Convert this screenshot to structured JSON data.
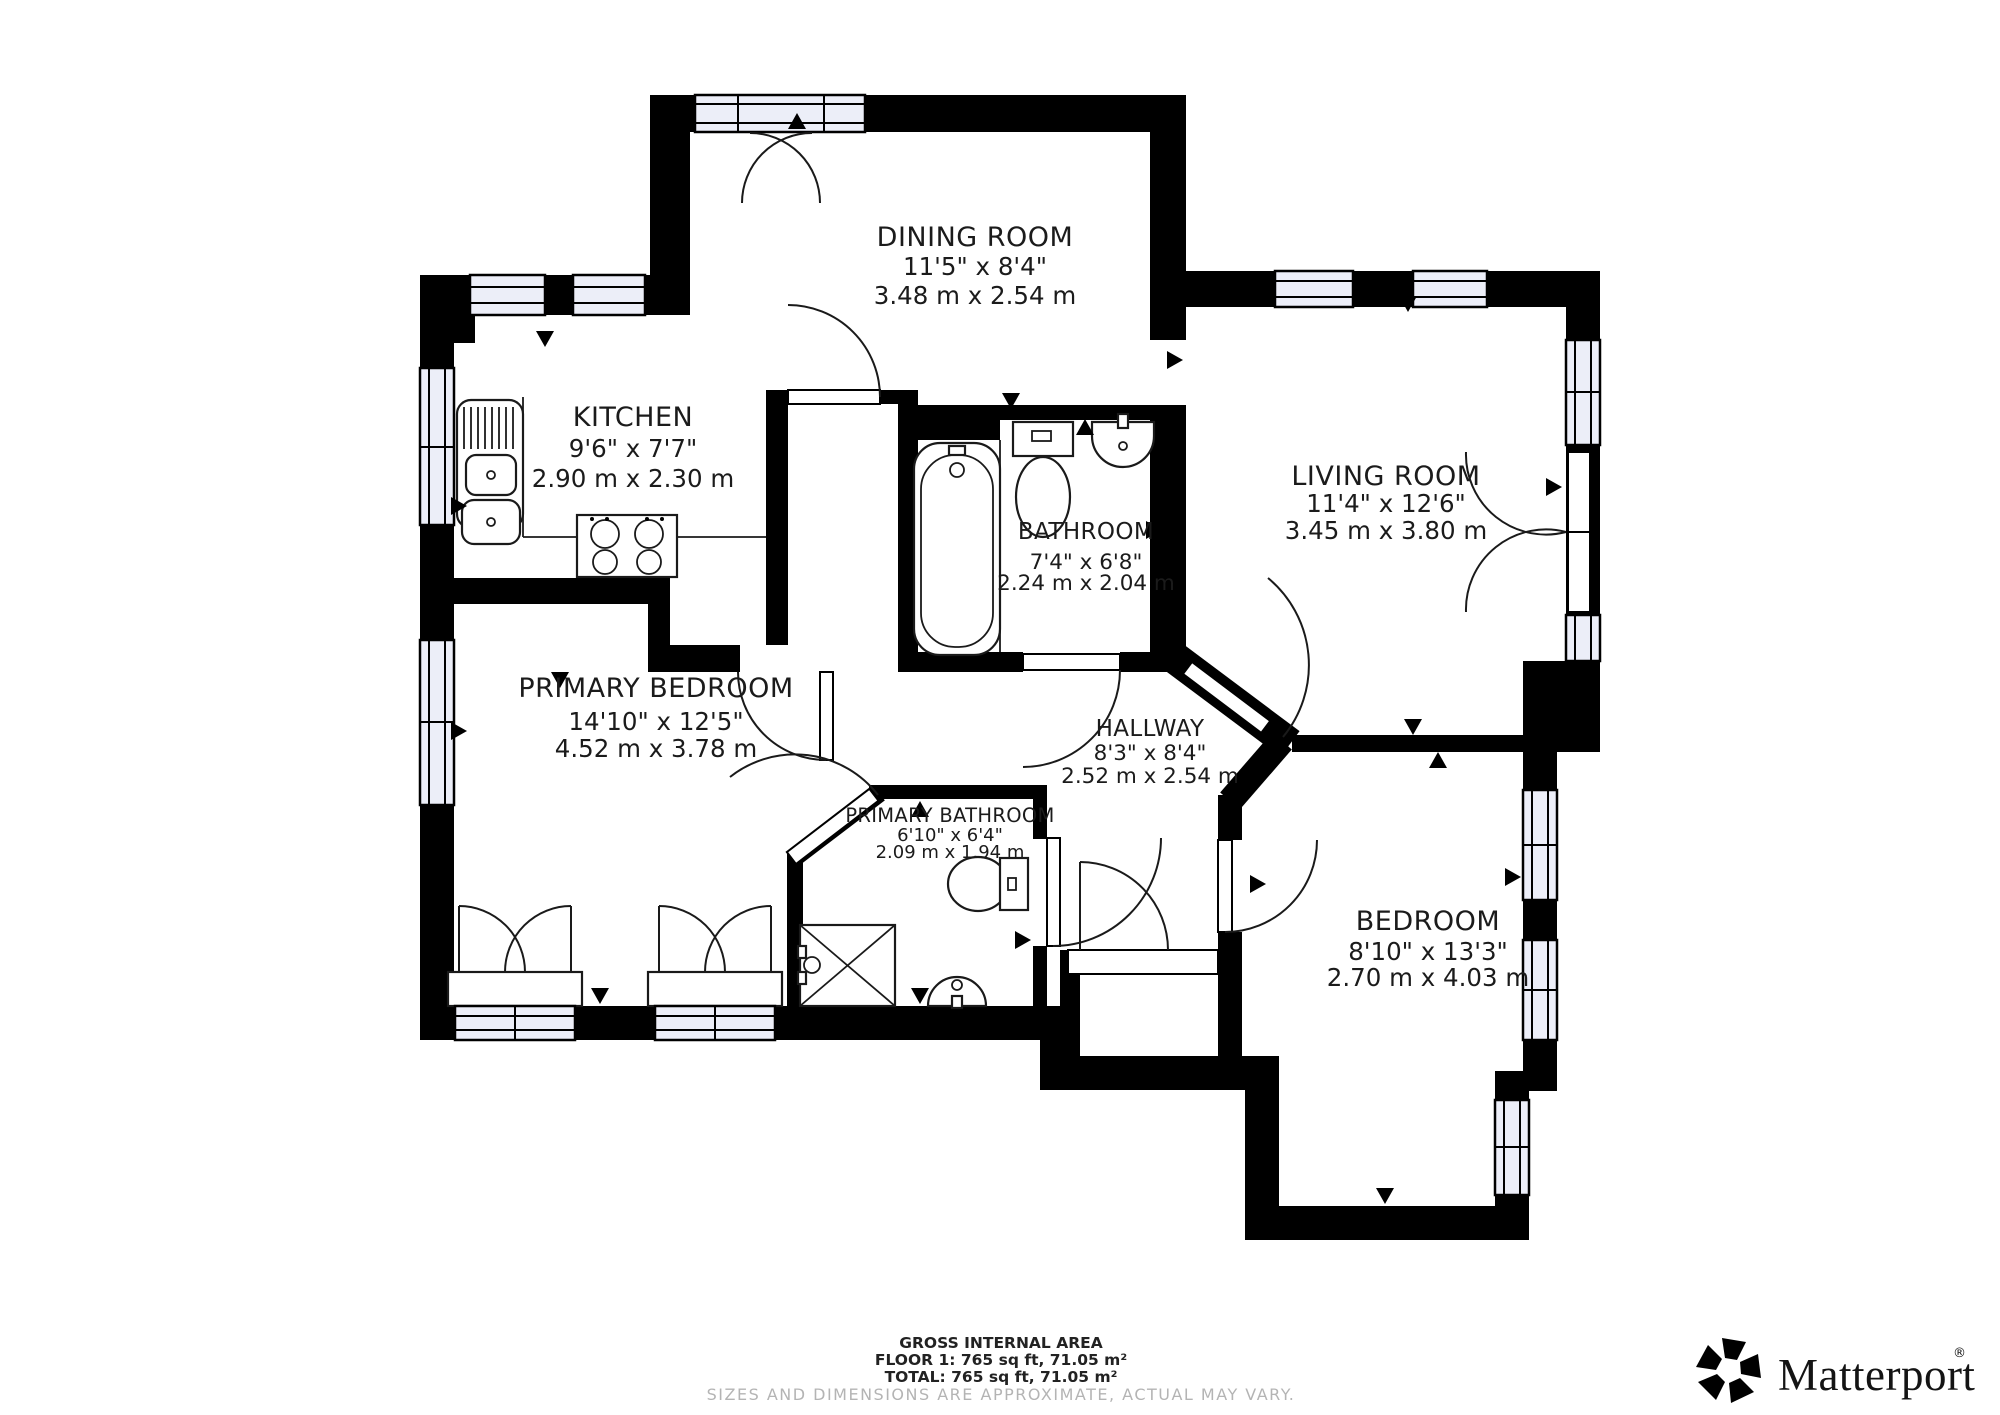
{
  "meta": {
    "title": "Floor plan - Floor 1"
  },
  "rooms": [
    {
      "id": "dining-room",
      "name": "DINING ROOM",
      "imperial": "11'5\" x 8'4\"",
      "metric": "3.48 m x 2.54 m"
    },
    {
      "id": "kitchen",
      "name": "KITCHEN",
      "imperial": "9'6\" x 7'7\"",
      "metric": "2.90 m x 2.30 m"
    },
    {
      "id": "living-room",
      "name": "LIVING ROOM",
      "imperial": "11'4\" x 12'6\"",
      "metric": "3.45 m x 3.80 m"
    },
    {
      "id": "bathroom",
      "name": "BATHROOM",
      "imperial": "7'4\" x 6'8\"",
      "metric": "2.24 m x 2.04 m"
    },
    {
      "id": "primary-bedroom",
      "name": "PRIMARY BEDROOM",
      "imperial": "14'10\" x 12'5\"",
      "metric": "4.52 m x 3.78 m"
    },
    {
      "id": "hallway",
      "name": "HALLWAY",
      "imperial": "8'3\" x 8'4\"",
      "metric": "2.52 m x 2.54 m"
    },
    {
      "id": "primary-bathroom",
      "name": "PRIMARY BATHROOM",
      "imperial": "6'10\" x 6'4\"",
      "metric": "2.09 m x 1.94 m"
    },
    {
      "id": "bedroom",
      "name": "BEDROOM",
      "imperial": "8'10\" x 13'3\"",
      "metric": "2.70 m x 4.03 m"
    }
  ],
  "footer": {
    "line1": "GROSS INTERNAL AREA",
    "line2": "FLOOR 1: 765 sq ft, 71.05 m²",
    "line3": "TOTAL: 765 sq ft, 71.05 m²",
    "disclaimer": "SIZES AND DIMENSIONS ARE APPROXIMATE, ACTUAL MAY VARY."
  },
  "branding": {
    "logo_text": "Matterport",
    "registered_mark": "®"
  },
  "colors": {
    "wall": "#000000",
    "floor": "#ffffff",
    "window_fill": "#eceef8",
    "muted_text": "#b4b4b4",
    "line": "#1a1a1a"
  }
}
